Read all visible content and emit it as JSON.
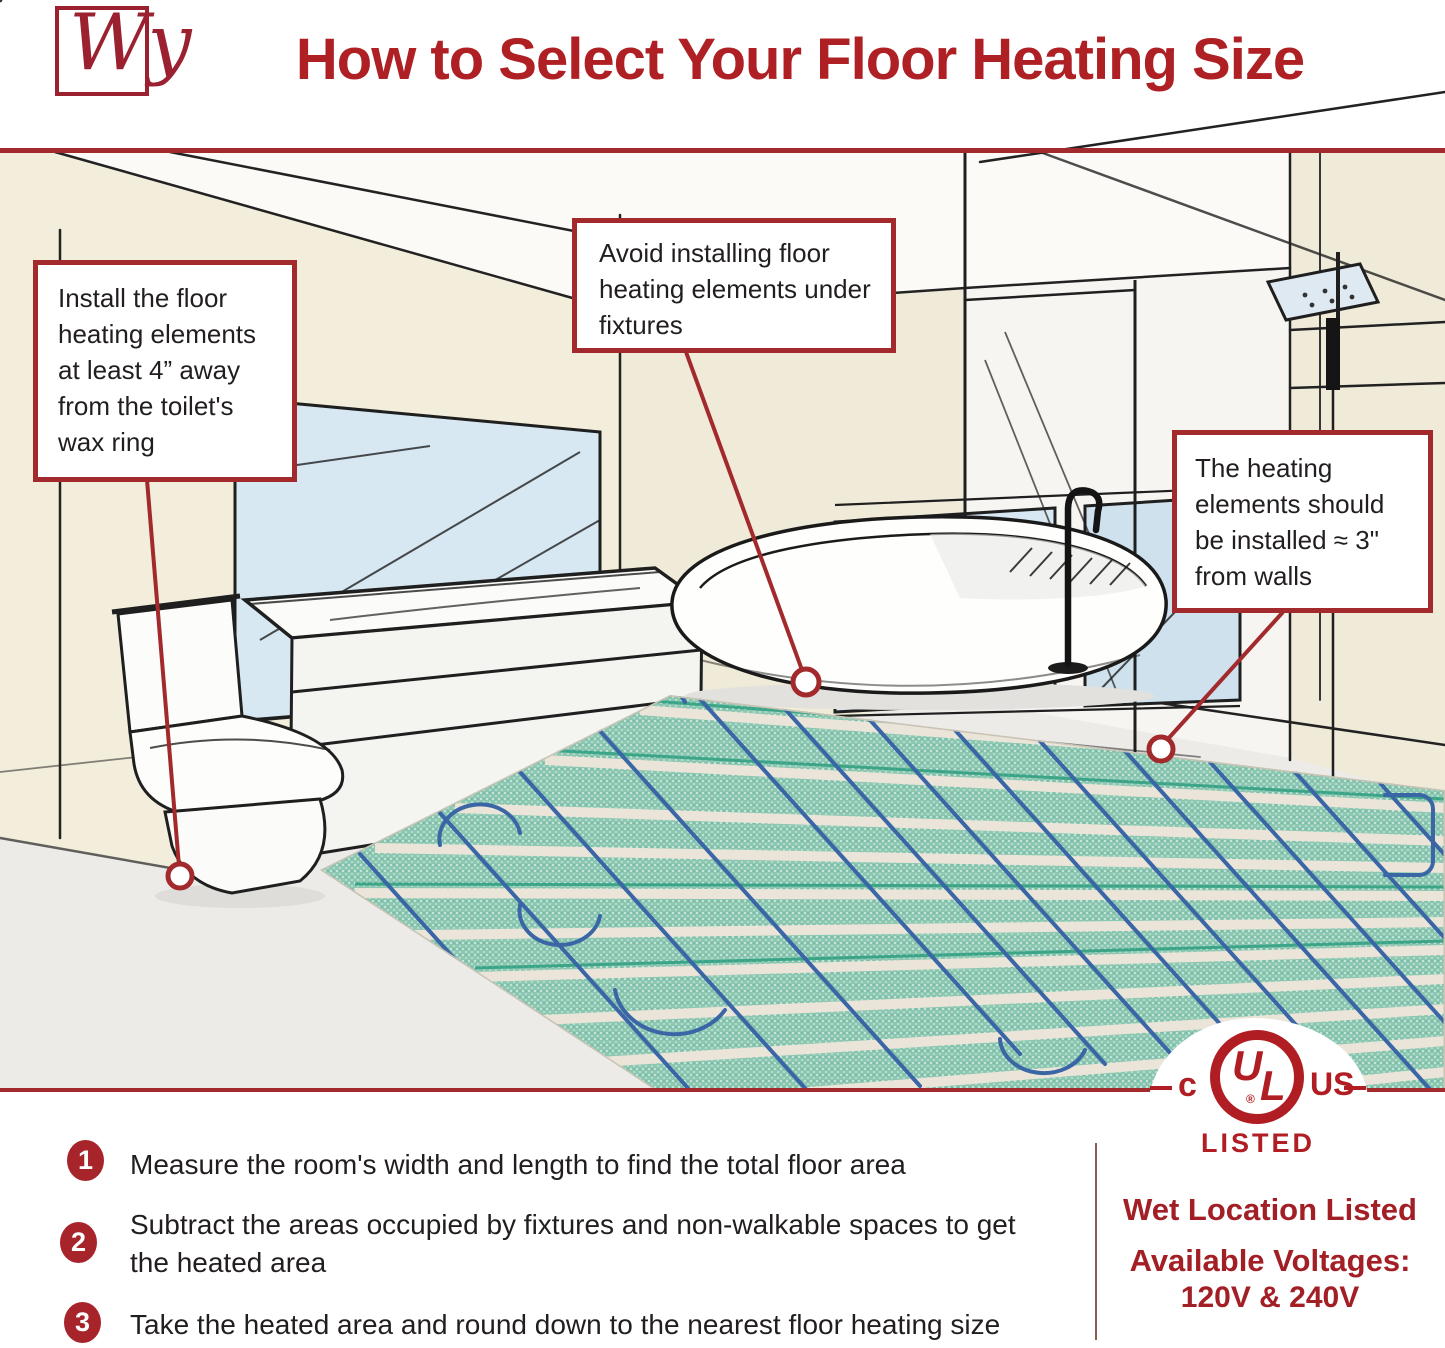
{
  "header": {
    "logo_text": "Wy",
    "title": "How to Select Your Floor Heating Size"
  },
  "callouts": [
    {
      "id": "toilet",
      "text": "Install the floor heating elements at least 4” away from the toilet's wax ring"
    },
    {
      "id": "fixtures",
      "text": "Avoid installing floor heating elements under fixtures"
    },
    {
      "id": "walls",
      "text": "The heating elements should be installed ≈ 3\" from walls"
    }
  ],
  "steps": [
    {
      "number": "1",
      "text": "Measure the room's width and length to find the total floor area"
    },
    {
      "number": "2",
      "text": "Subtract the areas occupied by fixtures and non-walkable spaces to get the heated area"
    },
    {
      "number": "3",
      "text": "Take the heated area and round down to the nearest floor heating size"
    }
  ],
  "certification": {
    "ul_left": "c",
    "ul_letter_u": "U",
    "ul_letter_l": "L",
    "ul_registered": "®",
    "ul_right": "US",
    "ul_listed": "LISTED",
    "wet_location": "Wet Location Listed",
    "voltages_label": "Available Voltages:",
    "voltages_value": "120V & 240V"
  },
  "colors": {
    "brand_red": "#A32A2C",
    "title_red": "#AE2024",
    "text_dark": "#221E1F",
    "wall_cream": "#F2EEDB",
    "window_blue": "#D7E8F2",
    "floor_gray": "#ECEBE8",
    "mat_green": "#8CC7B2",
    "mat_tape": "#EAE5D8",
    "mat_accent_green": "#2E9F80",
    "wire_blue": "#3A66A6"
  }
}
